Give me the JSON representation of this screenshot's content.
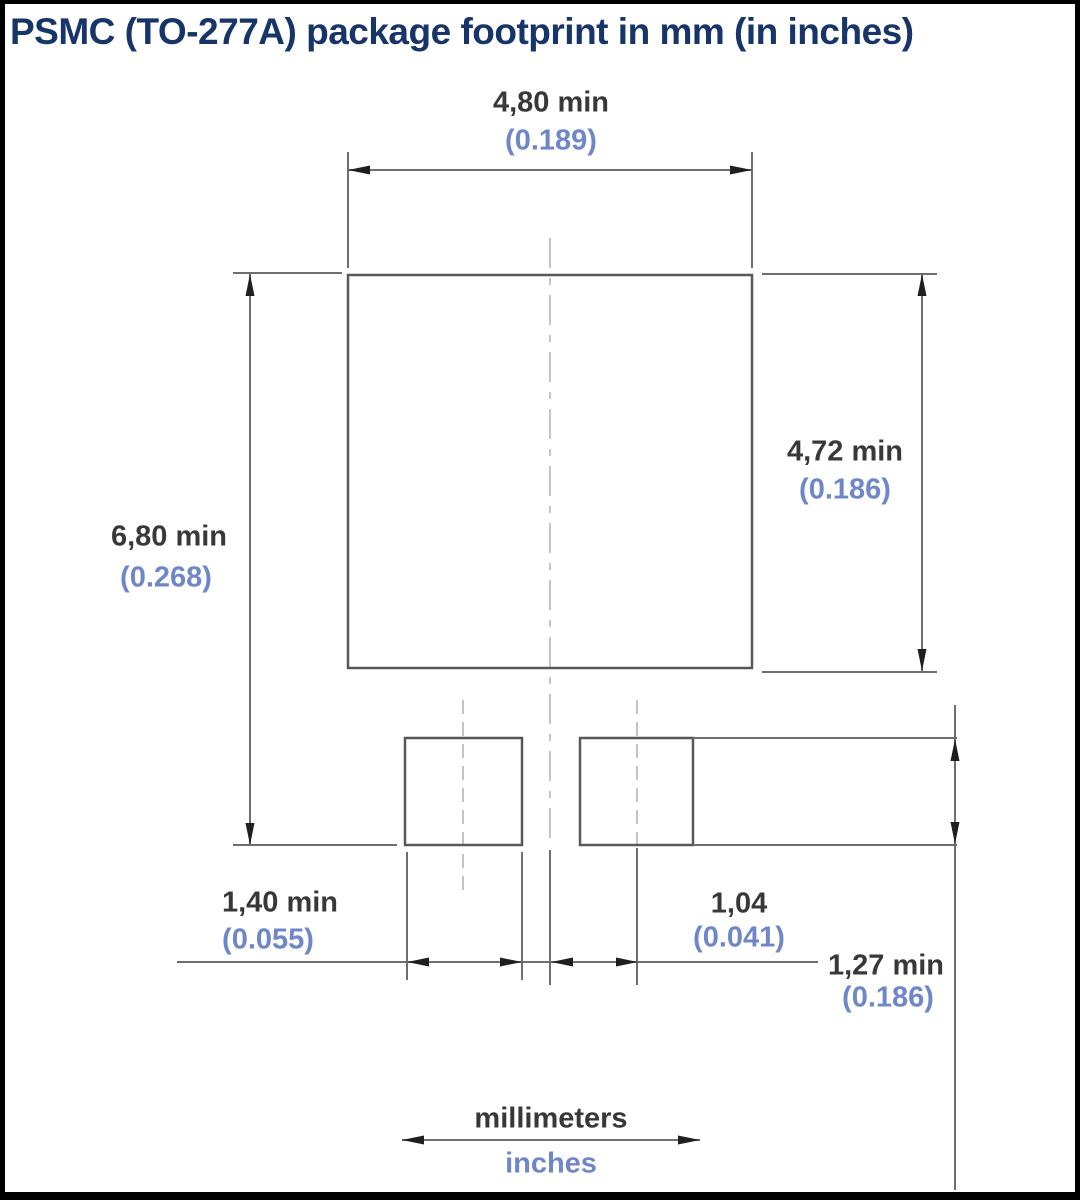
{
  "title": "PSMC (TO-277A) package footprint in mm (in inches)",
  "dimensions": {
    "top_width": {
      "mm": "4,80 min",
      "inch": "(0.189)"
    },
    "right_height": {
      "mm": "4,72 min",
      "inch": "(0.186)"
    },
    "left_overall_height": {
      "mm": "6,80 min",
      "inch": "(0.268)"
    },
    "pin_pad_width": {
      "mm": "1,40 min",
      "inch": "(0.055)"
    },
    "pin_pad_center_offset": {
      "mm": "1,04",
      "inch": "(0.041)"
    },
    "pin_pad_height": {
      "mm": "1,27 min",
      "inch": "(0.186)"
    }
  },
  "legend": {
    "millimeters": "millimeters",
    "inches": "inches"
  },
  "colors": {
    "title": "#173569",
    "mm_text": "#383838",
    "inch_text": "#6f87c8",
    "line": "#6e6e6e",
    "shape": "#585858",
    "arrow": "#1f1f1f",
    "centerline": "#c4c4c4",
    "border": "#000000",
    "background": "#ffffff"
  }
}
